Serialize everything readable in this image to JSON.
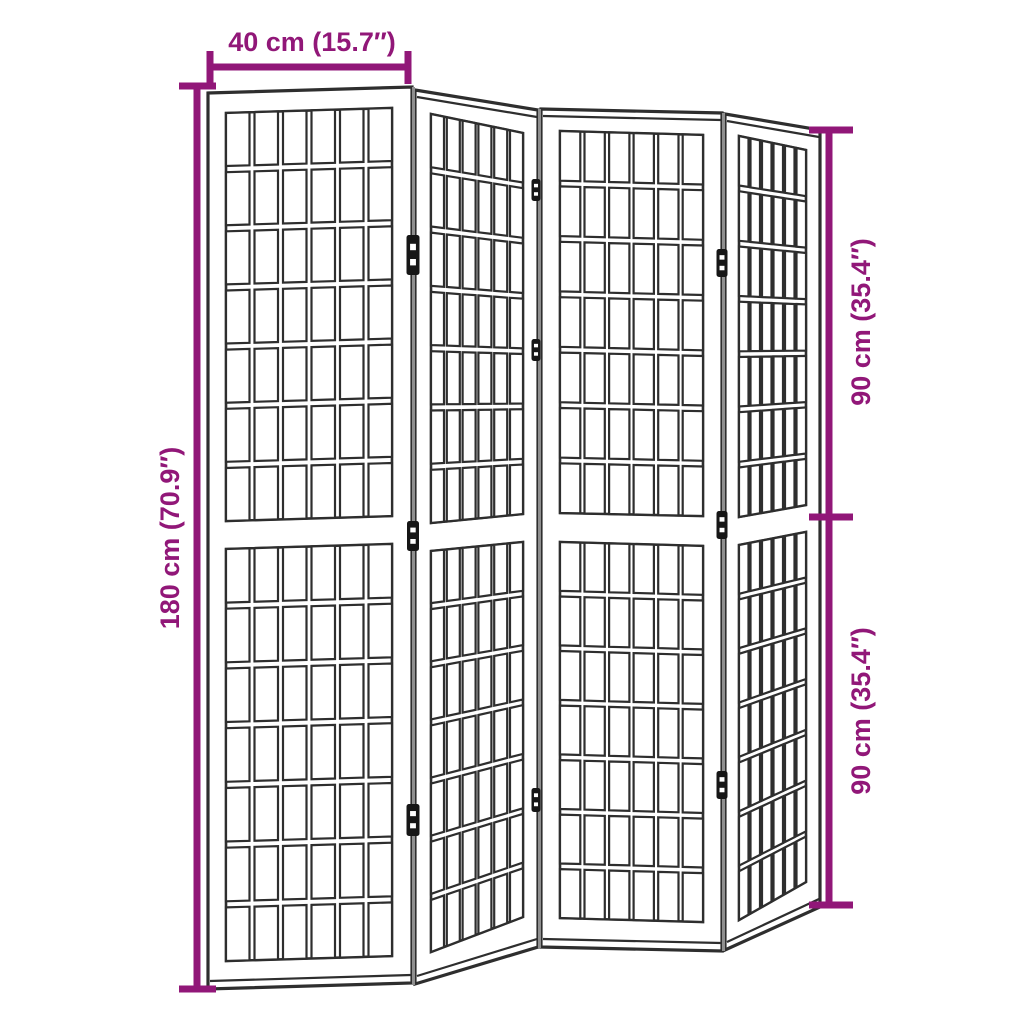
{
  "colors": {
    "background": "#ffffff",
    "accent": "#911778",
    "line": "#2e2e2e",
    "junction": "#8f8f8f",
    "hinge": "#161616",
    "panel_fill": "#ffffff"
  },
  "dimensions": {
    "top": {
      "label": "40 cm (15.7″)"
    },
    "left": {
      "label": "180 cm (70.9″)"
    },
    "right_upper": {
      "label": "90 cm (35.4″)"
    },
    "right_lower": {
      "label": "90 cm (35.4″)"
    }
  },
  "screen": {
    "panel_count": 4,
    "halves_per_panel": 2,
    "grid": {
      "cols": 6,
      "rows_per_half": 7,
      "gap_u": 0.03,
      "gap_v": 0.015
    },
    "panels": [
      {
        "top_band": false,
        "outer": [
          [
            208,
            93
          ],
          [
            412,
            87
          ],
          [
            412,
            983
          ],
          [
            208,
            989
          ]
        ],
        "upper": [
          [
            226,
            113
          ],
          [
            392,
            108
          ],
          [
            392,
            516
          ],
          [
            226,
            521
          ]
        ],
        "lower": [
          [
            226,
            549
          ],
          [
            392,
            544
          ],
          [
            392,
            956
          ],
          [
            226,
            961
          ]
        ]
      },
      {
        "top_band": true,
        "outer": [
          [
            415,
            90
          ],
          [
            538,
            110
          ],
          [
            538,
            947
          ],
          [
            415,
            984
          ]
        ],
        "upper": [
          [
            431,
            114
          ],
          [
            523,
            133
          ],
          [
            523,
            514
          ],
          [
            431,
            523
          ]
        ],
        "lower": [
          [
            431,
            551
          ],
          [
            523,
            542
          ],
          [
            523,
            917
          ],
          [
            431,
            952
          ]
        ]
      },
      {
        "top_band": true,
        "outer": [
          [
            541,
            109
          ],
          [
            722,
            113
          ],
          [
            722,
            951
          ],
          [
            541,
            947
          ]
        ],
        "upper": [
          [
            560,
            131
          ],
          [
            703,
            135
          ],
          [
            703,
            516
          ],
          [
            560,
            513
          ]
        ],
        "lower": [
          [
            560,
            542
          ],
          [
            703,
            546
          ],
          [
            703,
            922
          ],
          [
            560,
            918
          ]
        ]
      },
      {
        "top_band": true,
        "outer": [
          [
            725,
            114
          ],
          [
            820,
            130
          ],
          [
            820,
            907
          ],
          [
            725,
            950
          ]
        ],
        "upper": [
          [
            739,
            136
          ],
          [
            806,
            150
          ],
          [
            806,
            505
          ],
          [
            739,
            517
          ]
        ],
        "lower": [
          [
            739,
            545
          ],
          [
            806,
            532
          ],
          [
            806,
            882
          ],
          [
            739,
            920
          ]
        ]
      }
    ],
    "junctions": [
      [
        413.5,
        87,
        985
      ],
      [
        539.5,
        109,
        948
      ],
      [
        723.5,
        113,
        951
      ]
    ],
    "hinges": [
      [
        413,
        255,
        13,
        40
      ],
      [
        413,
        536,
        12,
        30
      ],
      [
        413,
        820,
        13,
        32
      ],
      [
        536,
        190,
        9,
        22
      ],
      [
        536,
        350,
        9,
        22
      ],
      [
        536,
        800,
        9,
        24
      ],
      [
        722,
        263,
        11,
        28
      ],
      [
        722,
        525,
        11,
        28
      ],
      [
        722,
        785,
        11,
        28
      ]
    ]
  }
}
